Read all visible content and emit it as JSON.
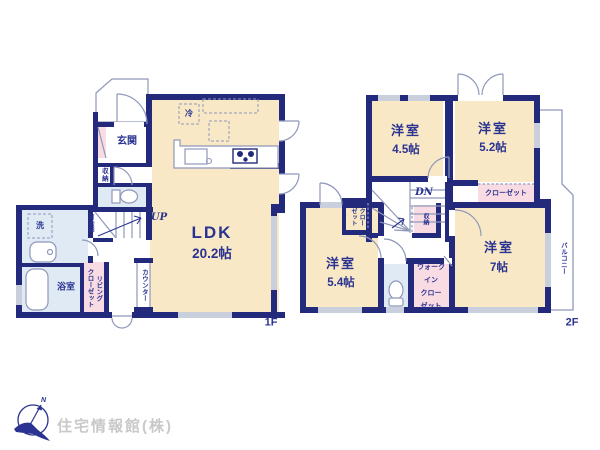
{
  "colors": {
    "wall": "#232a7c",
    "room_cream": "#f8e8c5",
    "room_blue": "#dfeaf4",
    "closet_pink": "#f9dce3",
    "window_gray": "#c9cfdd",
    "thin_line": "#8f98ba",
    "text": "#2a3391",
    "logo_text": "#c9c9c9"
  },
  "floor1": {
    "label": "1F",
    "ldk_name": "LDK",
    "ldk_size": "20.2帖",
    "entrance": "玄関",
    "storage": "収納",
    "movable_shelf": "可動棚",
    "up": "UP",
    "laundry": "洗",
    "bath": "浴室",
    "living_closet": "リビング\nクローゼット",
    "counter": "カウンター",
    "fridge": "冷"
  },
  "floor2": {
    "label": "2F",
    "dn": "DN",
    "room45_name": "洋室",
    "room45_size": "4.5帖",
    "room52_name": "洋室",
    "room52_size": "5.2帖",
    "room54_name": "洋室",
    "room54_size": "5.4帖",
    "room7_name": "洋室",
    "room7_size": "7帖",
    "closet52": "クローゼット",
    "closet54": "クロー\nゼット",
    "storage": "収納",
    "walkin_closet": "ウォーク\nイン\nクロー\nゼット",
    "balcony": "バルコニー"
  },
  "footer": {
    "company": "住宅情報館(株)",
    "compass_n": "N"
  }
}
